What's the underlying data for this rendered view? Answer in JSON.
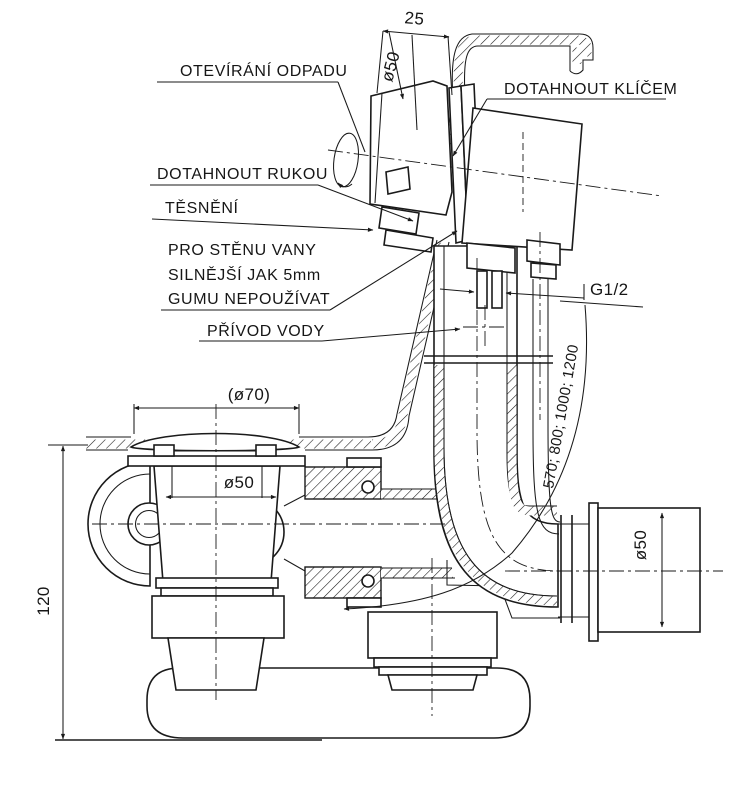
{
  "drawing": {
    "title_hint": "bath waste and overflow fitting section",
    "colors": {
      "line": "#1a1a1a",
      "background": "#ffffff"
    },
    "labels": {
      "otevirani_odpadu": "OTEVÍRÁNÍ ODPADU",
      "dotahnout_klicem": "DOTAHNOUT KLÍČEM",
      "dotahnout_rukou": "DOTAHNOUT RUKOU",
      "tesneni": "TĚSNĚNÍ",
      "note_line1": "PRO STĚNU VANY",
      "note_line2": "SILNĚJŠÍ JAK 5mm",
      "note_line3": "GUMU NEPOUŽÍVAT",
      "privod_vody": "PŘÍVOD VODY"
    },
    "dimensions": {
      "top_offset": "25",
      "overflow_diameter": "ø50",
      "inlet_thread": "G1/2",
      "pipe_lengths": "570; 800; 1000; 1200",
      "cap_diameter": "(ø70)",
      "waste_diameter": "ø50",
      "height": "120",
      "outlet_diameter": "ø50"
    }
  }
}
